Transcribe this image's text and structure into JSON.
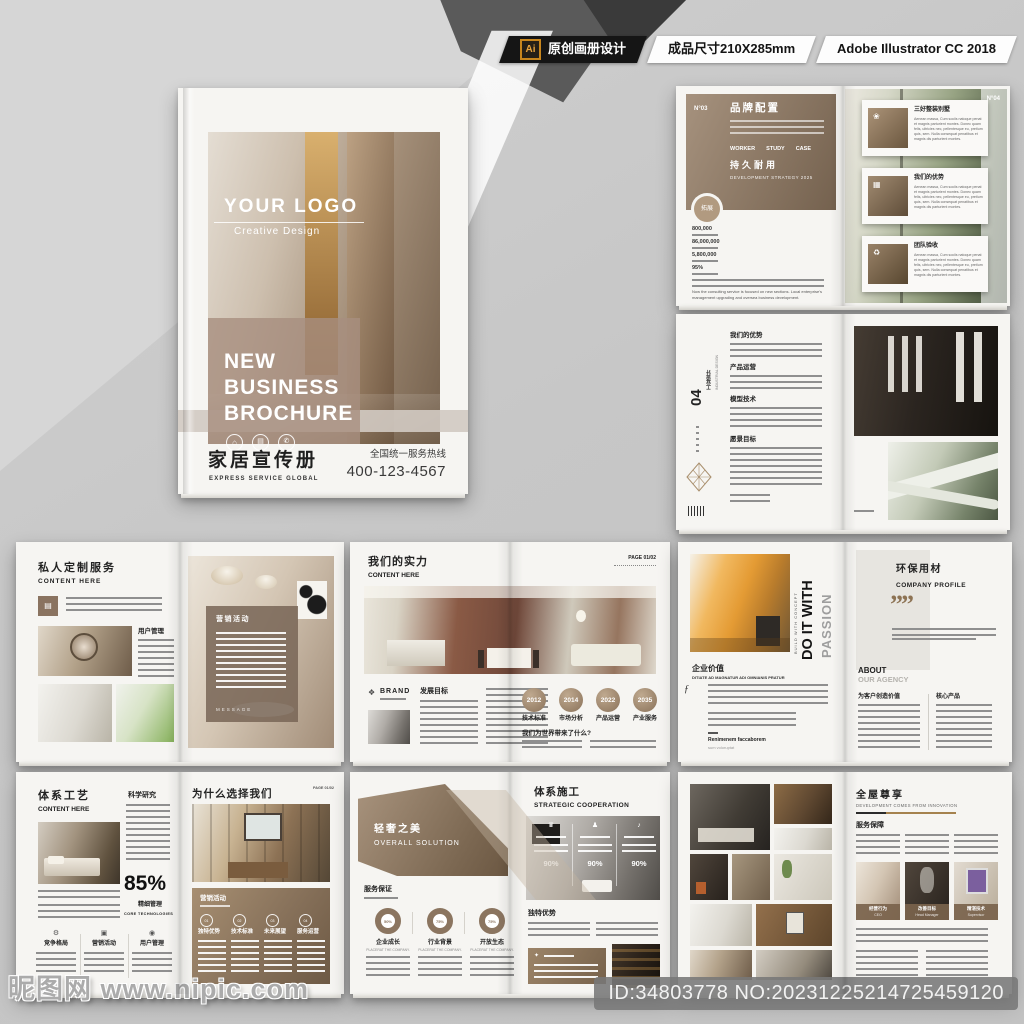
{
  "header": {
    "ai_badge": "Ai",
    "design_label": "原创画册设计",
    "size_label": "成品尺寸210X285mm",
    "software_label": "Adobe Illustrator CC 2018"
  },
  "cover": {
    "logo": "YOUR LOGO",
    "logo_subtitle": "Creative Design",
    "title_line1": "NEW",
    "title_line2": "BUSINESS",
    "title_line3": "BROCHURE",
    "cn_title": "家居宣传册",
    "cn_subtitle": "EXPRESS SERVICE GLOBAL",
    "hotline_label": "全国统一服务热线",
    "hotline_number": "400-123-4567"
  },
  "brand_spread": {
    "no_left": "N°03",
    "no_right": "N°04",
    "title": "品牌配置",
    "nav": [
      "WORKER",
      "STUDY",
      "CASE"
    ],
    "feature_title": "持久耐用",
    "feature_subtitle": "DEVELOPMENT STRATEGY 2025",
    "badge": "拓展",
    "stats": [
      "800,000",
      "86,000,000",
      "5,800,000",
      "95%"
    ],
    "note_en": "Now the consulting service is focused on new sections. Local enterprise's management upgrading and oversea business development.",
    "cards": [
      {
        "title": "三好整装别墅"
      },
      {
        "title": "我们的优势"
      },
      {
        "title": "团队验收"
      }
    ],
    "card_body": "Aenean massa, Cum sociis natoque penat et magnis parturient montes. Donec quam felis, ultricies nec, pellentesque eu, pretium quis, sem. Nulla consequat penatibus et magnis dis parturient montes."
  },
  "industrial_spread": {
    "number": "04",
    "title_cn": "工业设计",
    "title_en": "INDUSTRIAL DESIGN",
    "sections": [
      "我们的优势",
      "产品运营",
      "模型技术",
      "愿景目标"
    ]
  },
  "custom_spread": {
    "title": "私人定制服务",
    "subtitle": "CONTENT HERE",
    "section": "用户管理",
    "overlay_title": "营销活动",
    "overlay_footer": "MESSAGE"
  },
  "strength_spread": {
    "title": "我们的实力",
    "subtitle": "CONTENT HERE",
    "page_no": "PAGE 01/02",
    "brand": "BRAND",
    "section": "发展目标",
    "years": [
      "2012",
      "2014",
      "2022",
      "2035"
    ],
    "year_labels": [
      "技术标准",
      "市场分析",
      "产品运营",
      "产业服务"
    ],
    "question": "我们为世界带来了什么?"
  },
  "passion_spread": {
    "vertical_kicker": "BUILD WITH CONCEPT",
    "vertical_title": "DO IT WITH",
    "vertical_title2": "PASSION",
    "section_title": "企业价值",
    "section_subtitle": "DITIATE AD MAGNATUR ADI OMNIANIS PRATUR",
    "sign_name": "Renimenem faccaborem",
    "sign_sub": "sum voloruptat",
    "right_title": "环保用材",
    "right_subtitle": "COMPANY PROFILE",
    "quote_mark": "””",
    "about": "ABOUT",
    "about_sub": "OUR AGENCY",
    "col1_title": "为客户创造价值",
    "col2_title": "核心产品"
  },
  "craft_spread": {
    "title": "体系工艺",
    "subtitle": "CONTENT HERE",
    "section_right": "科学研究",
    "stat_value": "85%",
    "stat_label": "精细管理",
    "stat_sub": "CORE TECHNOLOGIES",
    "features": [
      "竞争格局",
      "营销活动",
      "用户管理"
    ],
    "right_title": "为什么选择我们",
    "page_no": "PAGE 01/02",
    "panel_title": "营销活动",
    "steps": [
      {
        "no": "01",
        "label": "独特优势"
      },
      {
        "no": "02",
        "label": "技术标准"
      },
      {
        "no": "03",
        "label": "未来展望"
      },
      {
        "no": "04",
        "label": "服务运营"
      }
    ]
  },
  "luxury_spread": {
    "title": "轻奢之美",
    "subtitle": "OVERALL SOLUTION",
    "section": "服务保证",
    "donuts": [
      {
        "pct": "50%",
        "label": "企业成长"
      },
      {
        "pct": "75%",
        "label": "行业背景"
      },
      {
        "pct": "75%",
        "label": "开放生态"
      }
    ],
    "donut_sub": "PLACERAT THE COMPANY.",
    "right_title": "体系施工",
    "right_subtitle": "STRATEGIC COOPERATION",
    "overlay_pcts": [
      "90%",
      "90%",
      "90%"
    ],
    "section_right": "独特优势"
  },
  "whole_spread": {
    "title": "全屋尊享",
    "subtitle": "DEVELOPMENT COMES FROM INNOVATION",
    "section": "服务保障",
    "captions": [
      {
        "title": "经营行为",
        "sub": "CEO"
      },
      {
        "title": "改善目标",
        "sub": "Head Manager"
      },
      {
        "title": "精湛技术",
        "sub": "Supervisor"
      }
    ]
  },
  "watermark": {
    "site": "昵图网 www.nipic.com",
    "id_text": "ID:34803778 NO:20231225214725459120"
  },
  "icons": {
    "home": "⌂",
    "sofa": "▤",
    "phone": "✆",
    "flower": "❀",
    "frame": "▦",
    "recycle": "♻",
    "diamond": "❖",
    "gear": "⚙",
    "monitor": "▣",
    "headset": "◉",
    "trophy": "♛",
    "person": "♟",
    "bell": "♪",
    "signature": "ƒ",
    "star": "✦",
    "grid": "▤"
  },
  "colors": {
    "accent_brown": "#8a7259",
    "panel_brown": "#7b6750",
    "badge_orange": "#e8a33d"
  }
}
